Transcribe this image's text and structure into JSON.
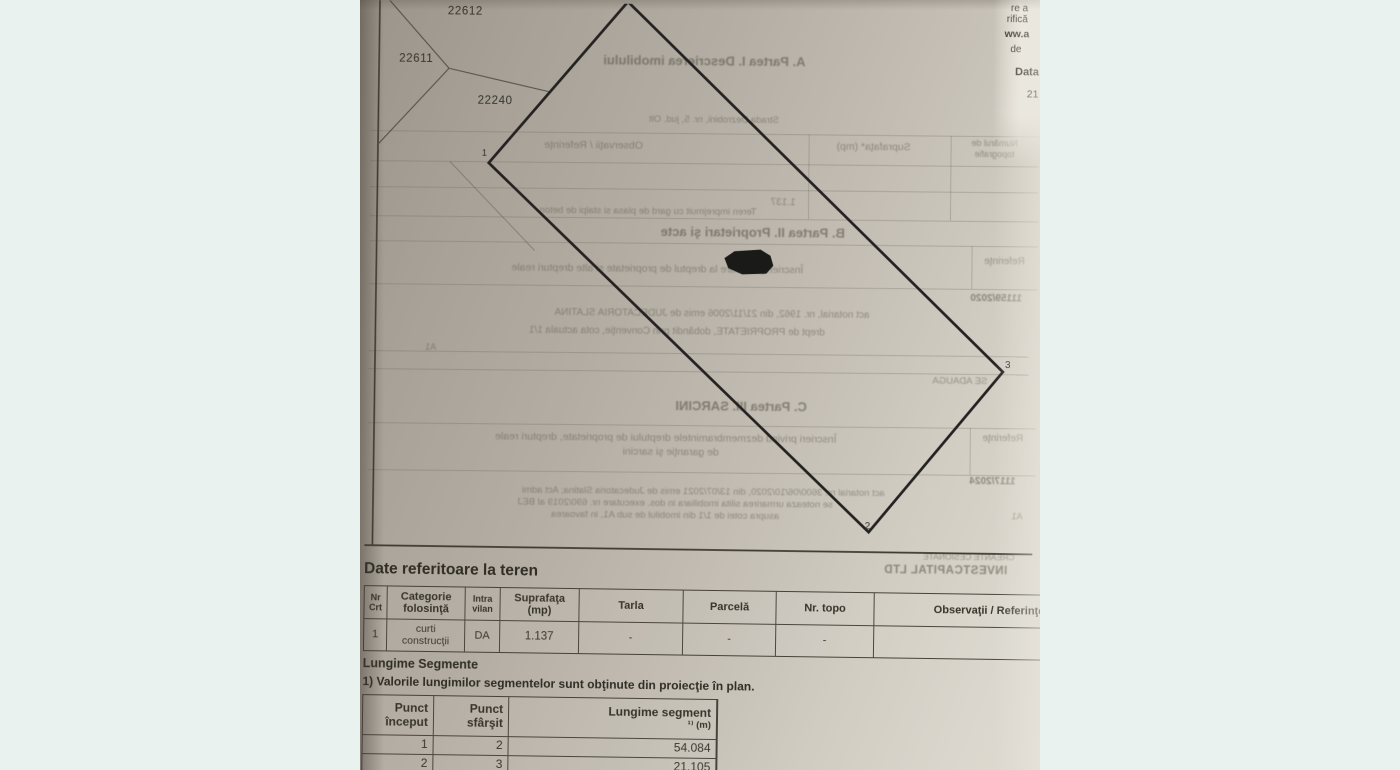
{
  "colors": {
    "backdrop": "#e9f2ef",
    "paper_dark": "#9a948a",
    "paper_light": "#ded9d0",
    "ink": "#3a372f",
    "plan_line": "#232220"
  },
  "page_edge_text": {
    "lines": [
      {
        "text": "re a"
      },
      {
        "text": "rifică"
      },
      {
        "text": "ww.a"
      },
      {
        "text": "de"
      },
      {
        "text": "Data"
      },
      {
        "text": "21"
      }
    ]
  },
  "plan": {
    "parcel_labels": [
      {
        "text": "22612"
      },
      {
        "text": "22611"
      },
      {
        "text": "22240"
      }
    ],
    "point_labels": [
      {
        "text": "1"
      },
      {
        "text": "2"
      },
      {
        "text": "3"
      }
    ]
  },
  "bleed_texts": [
    {
      "text": "A. Partea I. Descrierea imobilului"
    },
    {
      "text": "Strada Dezrobirii, nr. 5, jud. Olt"
    },
    {
      "text": "Observaţii / Referinţe"
    },
    {
      "text": "Suprafaţa* (mp)"
    },
    {
      "text": "Numărul de topografie"
    },
    {
      "text": "1.137"
    },
    {
      "text": "Teren imprejmuit cu gard de plasa si stalpi de beton"
    },
    {
      "text": "B. Partea II. Proprietari şi acte"
    },
    {
      "text": "Înscrieri privitoare la dreptul de proprietate şi alte drepturi reale"
    },
    {
      "text": "Referinţe"
    },
    {
      "text": "11159/2020"
    },
    {
      "text": "act notarial, nr. 1962, din 21/11/2006 emis de JUDECATORIA SLATINA"
    },
    {
      "text": "drept de PROPRIETATE, dobândit prin Convenţie, cota actuala 1/1"
    },
    {
      "text": "A1"
    },
    {
      "text": "SE ADAUGA"
    },
    {
      "text": "C. Partea III. SARCINI"
    },
    {
      "text": "Înscrieri privind dezmembramintele dreptului de proprietate, drepturi reale"
    },
    {
      "text": "de garanţie şi sarcini"
    },
    {
      "text": "Referinţe"
    },
    {
      "text": "1117/2024"
    },
    {
      "text": "act notarial nr. 3600/06/10/2020, din 13/07/2021 emis de Judecatoria Slatina; Act admi"
    },
    {
      "text": "se noteaza urmarirea silita imobiliara in dos. executare nr. 690/2019 al BEJ"
    },
    {
      "text": "asupra cotei de 1/1 din imobilul de sub A1, in favoarea"
    },
    {
      "text": "A1"
    },
    {
      "text": "CREANTE CESIONATE"
    },
    {
      "text": "INVESTCAPITAL LTD"
    }
  ],
  "terrain_section": {
    "title": "Date referitoare la teren",
    "columns": [
      {
        "l1": "Nr",
        "l2": "Crt"
      },
      {
        "l1": "Categorie",
        "l2": "folosinţă"
      },
      {
        "l1": "Intra",
        "l2": "vilan"
      },
      {
        "l1": "Suprafaţa",
        "l2": "(mp)"
      },
      {
        "l1": "Tarla",
        "l2": ""
      },
      {
        "l1": "Parcelă",
        "l2": ""
      },
      {
        "l1": "Nr. topo",
        "l2": ""
      },
      {
        "l1": "Observaţii / Referinţe",
        "l2": ""
      }
    ],
    "row": {
      "nr": "1",
      "categorie_l1": "curti",
      "categorie_l2": "construcţii",
      "intravilan": "DA",
      "suprafata": "1.137",
      "tarla": "-",
      "parcela": "-",
      "nr_topo": "-",
      "observatii": ""
    }
  },
  "segments_section": {
    "heading": "Lungime Segmente",
    "note": "1) Valorile lungimilor segmentelor sunt obţinute din proiecţie în plan.",
    "columns": [
      {
        "l1": "Punct",
        "l2": "început"
      },
      {
        "l1": "Punct",
        "l2": "sfârşit"
      },
      {
        "l1": "Lungime segment",
        "l2": "¹⁾ (m)"
      }
    ],
    "rows": [
      {
        "start": "1",
        "end": "2",
        "length": "54.084"
      },
      {
        "start": "2",
        "end": "3",
        "length": "21.105"
      }
    ]
  }
}
